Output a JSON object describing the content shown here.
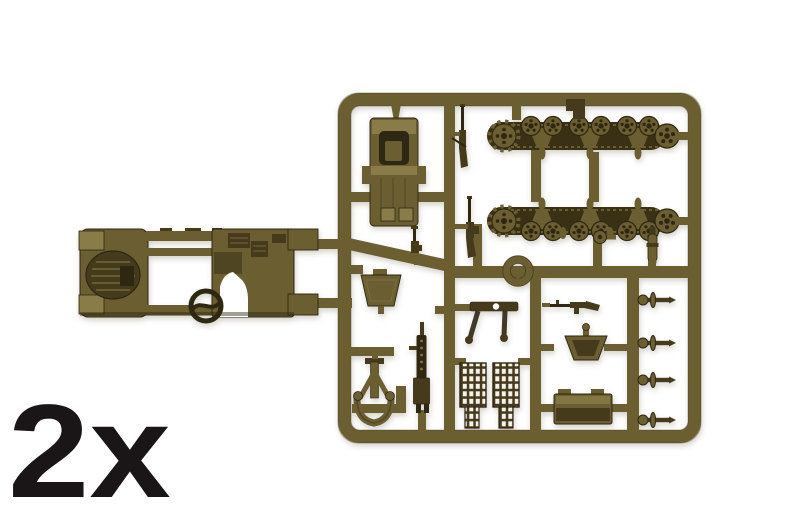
{
  "image": {
    "description": "Product photo of an olive-drab injection-molded plastic model sprue (half-track vehicle kit) on a white background",
    "type": "model-kit-sprue-photo"
  },
  "quantity_label": "2x",
  "colors": {
    "background": "#ffffff",
    "plastic_mid": "#6b5e31",
    "plastic_light": "#8a7c48",
    "plastic_dark": "#453a1c",
    "plastic_deep": "#2e2712",
    "track_band": "#3a3115",
    "label_text": "#1a1516"
  },
  "sprue": {
    "parts": [
      "half-track hull frame",
      "steering wheel",
      "cab body",
      "upper track run with road wheels, drive sprocket and idler",
      "lower track run with road wheels, drive sprocket and idler",
      "ring mount",
      "windscreen frame",
      "windshield bracket",
      "track link sections",
      "heavy machine gun",
      "gun pedestal mount",
      "rifles",
      "axle shafts",
      "crew seat",
      "stowage box",
      "shell",
      "spare road wheel"
    ]
  }
}
